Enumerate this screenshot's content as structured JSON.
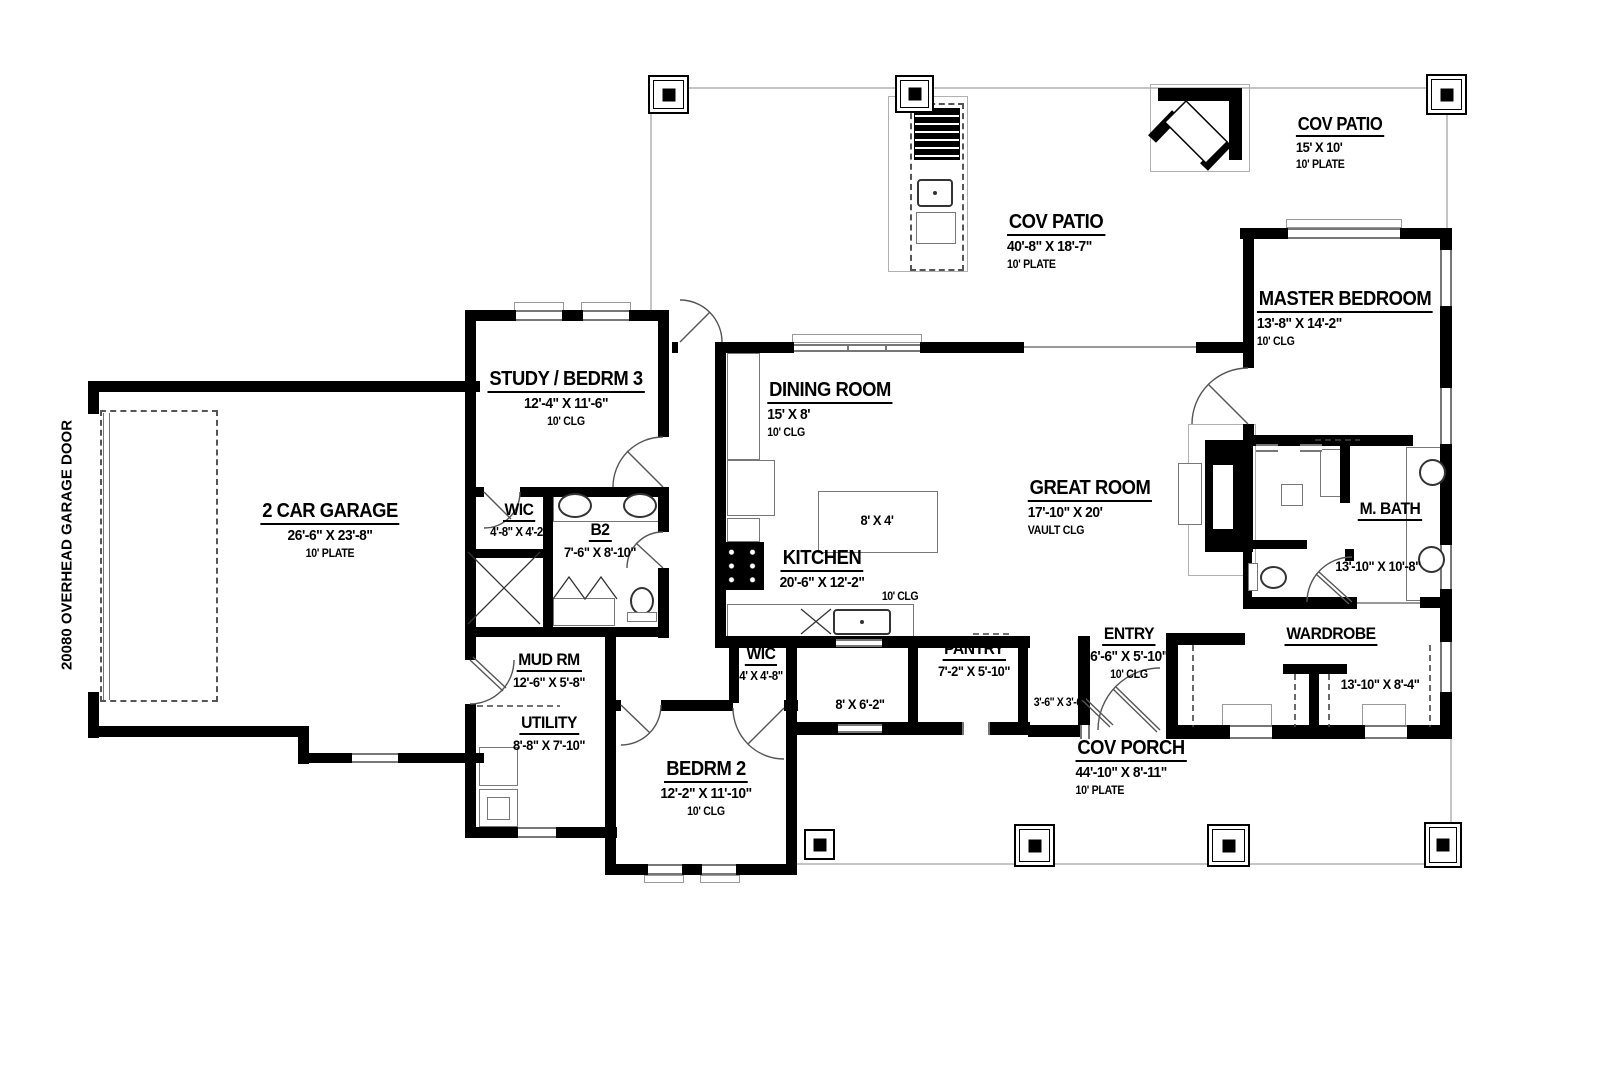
{
  "plan": {
    "side_label": "20080 OVERHEAD GARAGE DOOR",
    "rooms": [
      {
        "name": "2 CAR GARAGE",
        "dims": "26'-6\" X 23'-8\"",
        "note": "10' PLATE"
      },
      {
        "name": "STUDY / BEDRM 3",
        "dims": "12'-4\" X 11'-6\"",
        "note": "10' CLG"
      },
      {
        "name": "WIC",
        "dims": "4'-8\" X 4'-2\"",
        "note": ""
      },
      {
        "name": "B2",
        "dims": "7'-6\" X 8'-10\"",
        "note": ""
      },
      {
        "name": "MUD RM",
        "dims": "12'-6\" X 5'-8\"",
        "note": ""
      },
      {
        "name": "UTILITY",
        "dims": "8'-8\" X 7'-10\"",
        "note": ""
      },
      {
        "name": "BEDRM 2",
        "dims": "12'-2\" X 11'-10\"",
        "note": "10' CLG"
      },
      {
        "name": "WIC",
        "dims": "4' X 4'-8\"",
        "note": ""
      },
      {
        "name": "DINING ROOM",
        "dims": "15' X 8'",
        "note": "10' CLG"
      },
      {
        "name": "KITCHEN",
        "dims": "20'-6\" X 12'-2\"",
        "note": "10' CLG"
      },
      {
        "name": "PANTRY",
        "dims": "7'-2\" X 5'-10\"",
        "note": ""
      },
      {
        "name": "ENTRY",
        "dims": "6'-6\" X 5'-10\"",
        "note": "10' CLG"
      },
      {
        "name": "GREAT ROOM",
        "dims": "17'-10\" X 20'",
        "note": "VAULT CLG"
      },
      {
        "name": "MASTER BEDROOM",
        "dims": "13'-8\" X 14'-2\"",
        "note": "10' CLG"
      },
      {
        "name": "M. BATH",
        "dims": "13'-10\" X 10'-8\"",
        "note": ""
      },
      {
        "name": "WARDROBE",
        "dims": "13'-10\" X 8'-4\"",
        "note": ""
      },
      {
        "name": "COV PATIO",
        "dims": "40'-8\" X 18'-7\"",
        "note": "10' PLATE"
      },
      {
        "name": "COV PATIO",
        "dims": "15' X 10'",
        "note": "10' PLATE"
      },
      {
        "name": "COV PORCH",
        "dims": "44'-10\" X 8'-11\"",
        "note": "10' PLATE"
      }
    ],
    "annotations": {
      "island": "8' X 4'",
      "hall": "8' X 6'-2\"",
      "entry_closet": "3'-6\" X 3'-6\""
    },
    "colors": {
      "wall": "#000000",
      "window_line": "#777777",
      "patio_line": "#c4c4c4"
    }
  }
}
